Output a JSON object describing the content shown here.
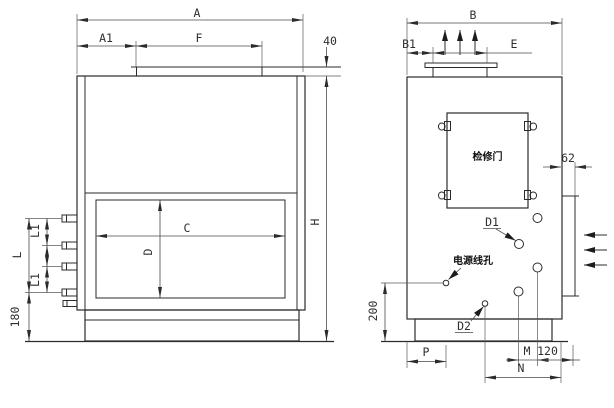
{
  "drawing": {
    "background": "#ffffff",
    "line_color": "#2b2b2b",
    "front_view": {
      "dims": {
        "a": "A",
        "a1": "A1",
        "f": "F",
        "top_flange_height": "40",
        "c": "C",
        "d": "D",
        "l1_upper": "L1",
        "l1_lower": "L1",
        "l": "L",
        "base_height": "180",
        "h": "H"
      }
    },
    "side_view": {
      "dims": {
        "b": "B",
        "b1": "B1",
        "e": "E",
        "side_flange_width": "62",
        "depth_200": "200",
        "p": "P",
        "m": "M",
        "offset_120": "120",
        "n": "N",
        "d1": "D1",
        "d2": "D2"
      },
      "labels": {
        "access_door": "检修门",
        "power_cable_hole": "电源线孔"
      }
    }
  }
}
